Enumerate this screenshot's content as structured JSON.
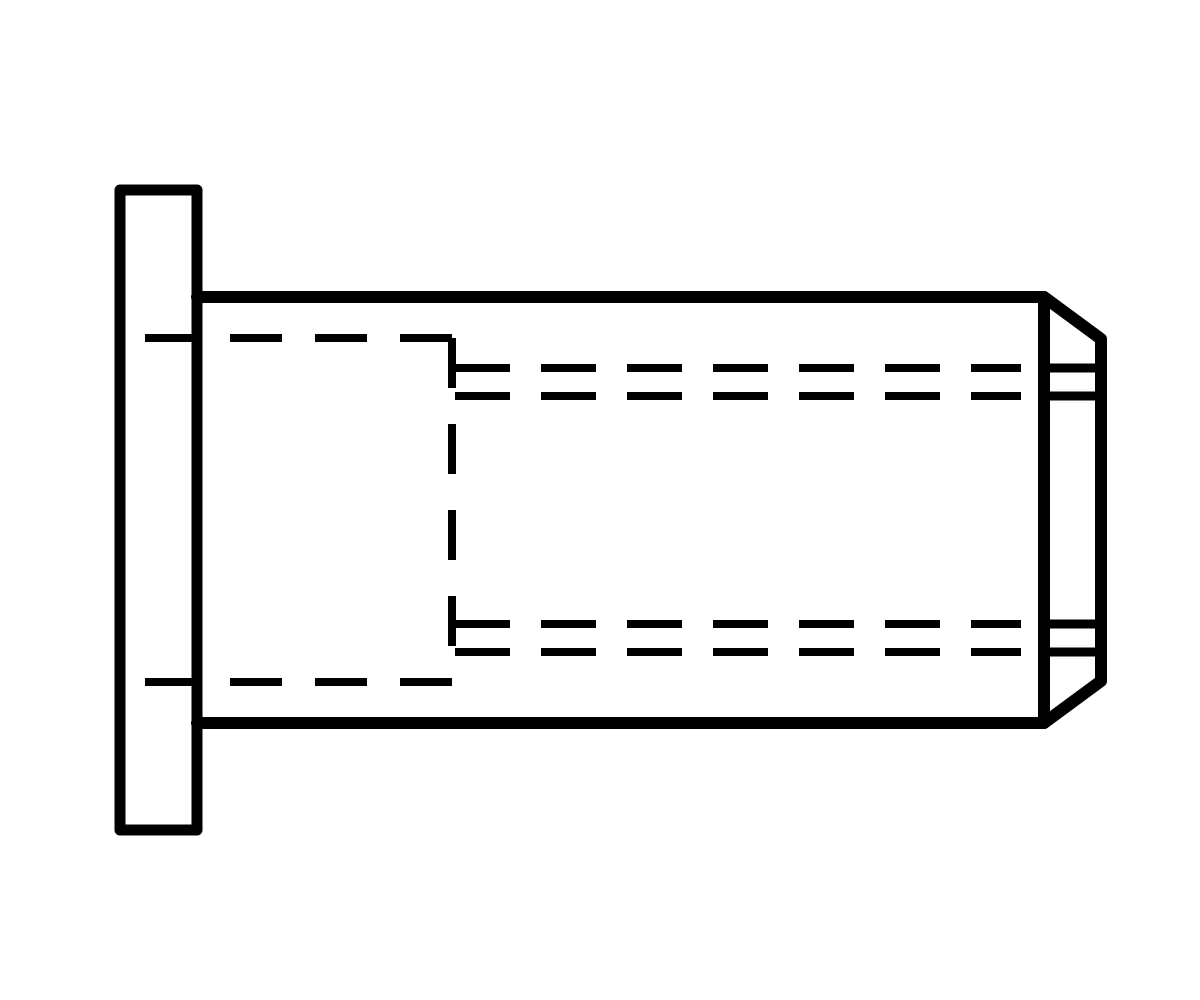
{
  "page": {
    "background_color": "#ffffff"
  },
  "drawing": {
    "name": "blind-rivet-nut-flat-head-side-view",
    "canvas": {
      "width": 1200,
      "height": 1000
    },
    "stroke_color": "#000000",
    "layers": [
      {
        "name": "outer-outline-solid",
        "stroke_width": 12,
        "linecap": "round",
        "linejoin": "round",
        "shapes": [
          {
            "name": "flange-outline",
            "type": "rect",
            "x": 120,
            "y": 190,
            "width": 77,
            "height": 640,
            "stroke_width": 11
          },
          {
            "name": "shank-outline",
            "type": "path",
            "d": "M 197 297 L 1044 297 L 1101 339 L 1101 681 L 1044 723 L 197 723"
          },
          {
            "name": "chamfer-shoulder-edge",
            "type": "line",
            "x1": 1044,
            "y1": 297,
            "x2": 1044,
            "y2": 723
          }
        ]
      },
      {
        "name": "thread-runout-solid",
        "stroke_width": 9,
        "linecap": "butt",
        "linejoin": "round",
        "shapes": [
          {
            "name": "thread-end-top-outer",
            "type": "line",
            "x1": 1044,
            "y1": 368,
            "x2": 1098,
            "y2": 368
          },
          {
            "name": "thread-end-top-inner",
            "type": "line",
            "x1": 1044,
            "y1": 396,
            "x2": 1098,
            "y2": 396
          },
          {
            "name": "thread-end-bottom-inner",
            "type": "line",
            "x1": 1044,
            "y1": 624,
            "x2": 1098,
            "y2": 624
          },
          {
            "name": "thread-end-bottom-outer",
            "type": "line",
            "x1": 1044,
            "y1": 652,
            "x2": 1098,
            "y2": 652
          }
        ]
      },
      {
        "name": "hidden-lines-dashed",
        "stroke_width": 8,
        "linecap": "butt",
        "linejoin": "round",
        "shapes": [
          {
            "name": "bore-hidden-top",
            "type": "line",
            "x1": 145,
            "y1": 338,
            "x2": 455,
            "y2": 338,
            "dash": "52 33"
          },
          {
            "name": "bore-hidden-bottom",
            "type": "line",
            "x1": 145,
            "y1": 682,
            "x2": 455,
            "y2": 682,
            "dash": "52 33"
          },
          {
            "name": "bore-step-hidden",
            "type": "line",
            "x1": 452,
            "y1": 338,
            "x2": 452,
            "y2": 682,
            "dash": "50 36"
          },
          {
            "name": "thread-hidden-top-outer",
            "type": "line",
            "x1": 455,
            "y1": 368,
            "x2": 1021,
            "y2": 368,
            "dash": "55 31"
          },
          {
            "name": "thread-hidden-top-inner",
            "type": "line",
            "x1": 455,
            "y1": 396,
            "x2": 1021,
            "y2": 396,
            "dash": "55 31"
          },
          {
            "name": "thread-hidden-bottom-inner",
            "type": "line",
            "x1": 455,
            "y1": 624,
            "x2": 1021,
            "y2": 624,
            "dash": "55 31"
          },
          {
            "name": "thread-hidden-bottom-outer",
            "type": "line",
            "x1": 455,
            "y1": 652,
            "x2": 1021,
            "y2": 652,
            "dash": "55 31"
          }
        ]
      }
    ]
  }
}
